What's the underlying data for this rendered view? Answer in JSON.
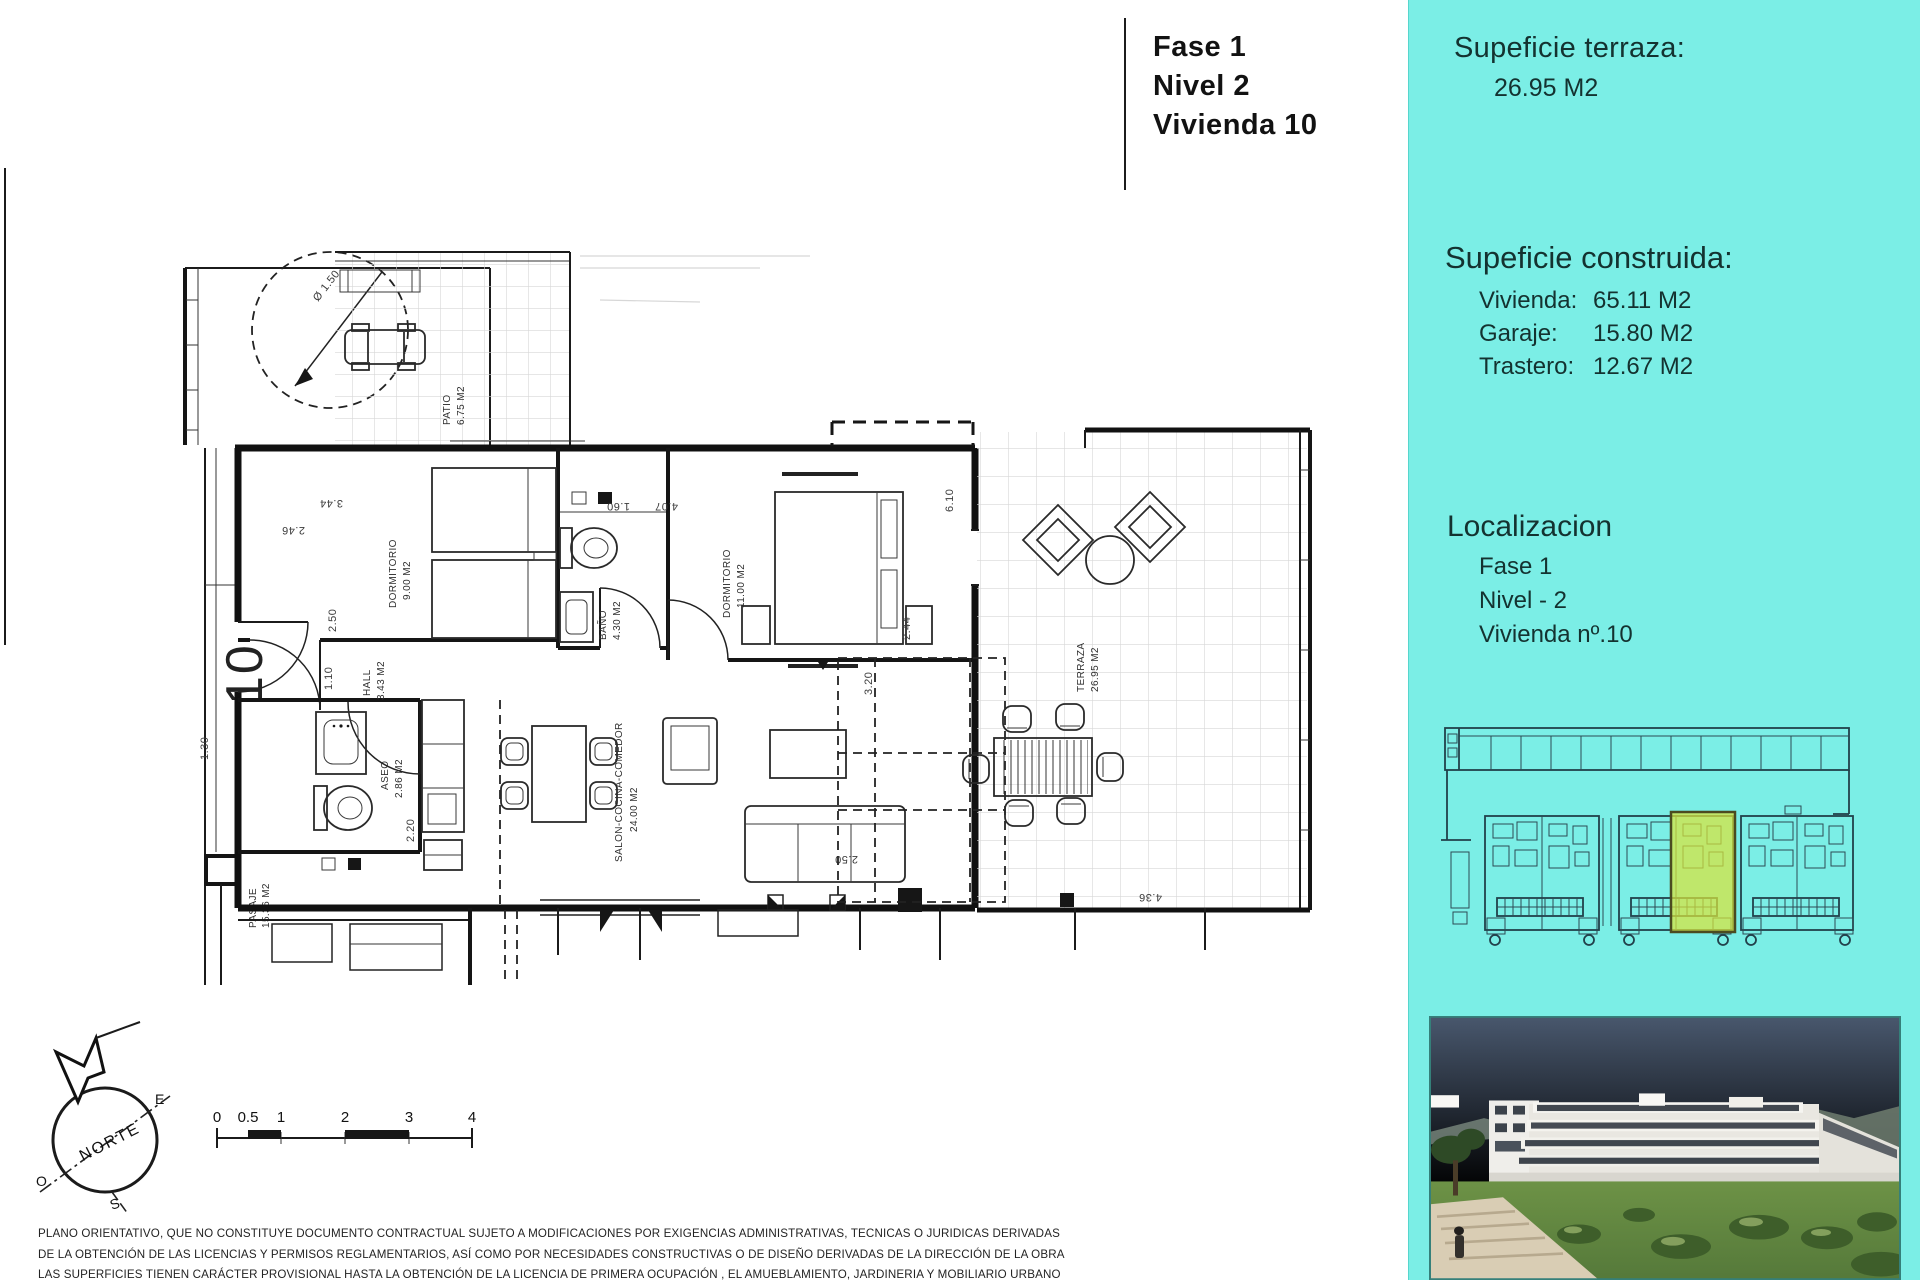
{
  "title_block": {
    "phase": "Fase 1",
    "level": "Nivel 2",
    "unit": "Vivienda  10"
  },
  "sidebar": {
    "accent_bg": "#7beee6",
    "terrace_heading": "Supeficie terraza:",
    "terrace_value": "26.95 M2",
    "built_heading": "Supeficie construida:",
    "built_rows": [
      {
        "label": "Vivienda:",
        "value": "65.11 M2"
      },
      {
        "label": "Garaje:",
        "value": "15.80 M2"
      },
      {
        "label": "Trastero:",
        "value": "12.67 M2"
      }
    ],
    "location_heading": "Localizacion",
    "location_lines": [
      "Fase 1",
      "Nivel - 2",
      "Vivienda nº.10"
    ],
    "siteplan_highlight_color": "#d9e53b"
  },
  "plan": {
    "unit_number": "10",
    "labels": {
      "patio": {
        "name": "PATIO",
        "area": "6.75 M2"
      },
      "dormitorio1": {
        "name": "DORMITORIO",
        "area": "9.00 M2"
      },
      "bano": {
        "name": "BAÑO",
        "area": "4.30 M2"
      },
      "dormitorio2": {
        "name": "DORMITORIO",
        "area": "11.00 M2"
      },
      "hall": {
        "name": "HALL",
        "area": "3.43 M2"
      },
      "aseo": {
        "name": "ASEO",
        "area": "2.86 M2"
      },
      "salon": {
        "name": "SALON-COCINA-COMEDOR",
        "area": "24.00 M2"
      },
      "terraza": {
        "name": "TERRAZA",
        "area": "26.95 M2"
      },
      "pasaje": {
        "name": "PASAJE",
        "area": "15.36 M2"
      }
    },
    "dims": {
      "w246": "2.46",
      "w344": "3.44",
      "h250": "2.50",
      "h110": "1.10",
      "w160": "1.60",
      "w407": "4.07",
      "h220": "2.20",
      "h320": "3.20",
      "h610": "6.10",
      "h244": "2.44",
      "w250b": "2.50",
      "w436": "4.36",
      "h130": "1.30",
      "diameter": "Ø 1.50"
    }
  },
  "compass": {
    "north": "NORTE",
    "east": "E",
    "west": "O",
    "south": "S"
  },
  "scalebar": {
    "ticks": [
      "0",
      "0.5",
      "1",
      "2",
      "3",
      "4"
    ]
  },
  "disclaimer": {
    "line1": "PLANO ORIENTATIVO, QUE NO CONSTITUYE DOCUMENTO CONTRACTUAL SUJETO A MODIFICACIONES POR EXIGENCIAS ADMINISTRATIVAS, TECNICAS O JURIDICAS DERIVADAS",
    "line2": "DE LA OBTENCIÓN DE LAS LICENCIAS Y PERMISOS REGLAMENTARIOS, ASÍ COMO POR NECESIDADES CONSTRUCTIVAS  O DE DISEÑO DERIVADAS DE LA DIRECCIÓN DE LA OBRA",
    "line3": "LAS SUPERFICIES TIENEN CARÁCTER PROVISIONAL HASTA LA OBTENCIÓN DE LA LICENCIA DE PRIMERA OCUPACIÓN , EL AMUEBLAMIENTO, JARDINERIA Y MOBILIARIO URBANO"
  }
}
